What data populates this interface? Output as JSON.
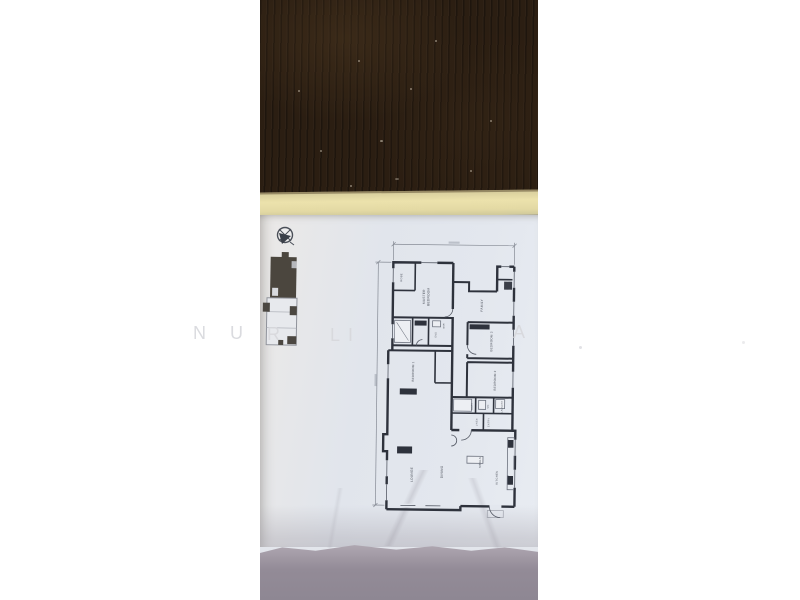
{
  "watermark": {
    "letters": {
      "n": "N",
      "u": "U",
      "r": "R",
      "l": "L",
      "i": "I",
      "a": "A"
    }
  },
  "floor_plan": {
    "rooms": {
      "master1": "MASTER",
      "master2": "BEDROOM",
      "robe": "ROBE",
      "wir": "WIR",
      "ens": "ENS",
      "family": "FAMILY",
      "bed3": "BEDROOM 3",
      "bed1": "BEDROOM 1",
      "bed2": "BEDROOM 2",
      "bath": "BATH",
      "wc": "WC",
      "laundry": "LAUNDRY",
      "linen": "LINEN",
      "entry": "ENTRY",
      "lounge": "LOUNGE",
      "dining": "DINING",
      "meals": "MEALS",
      "kitchen": "KITCHEN"
    }
  }
}
